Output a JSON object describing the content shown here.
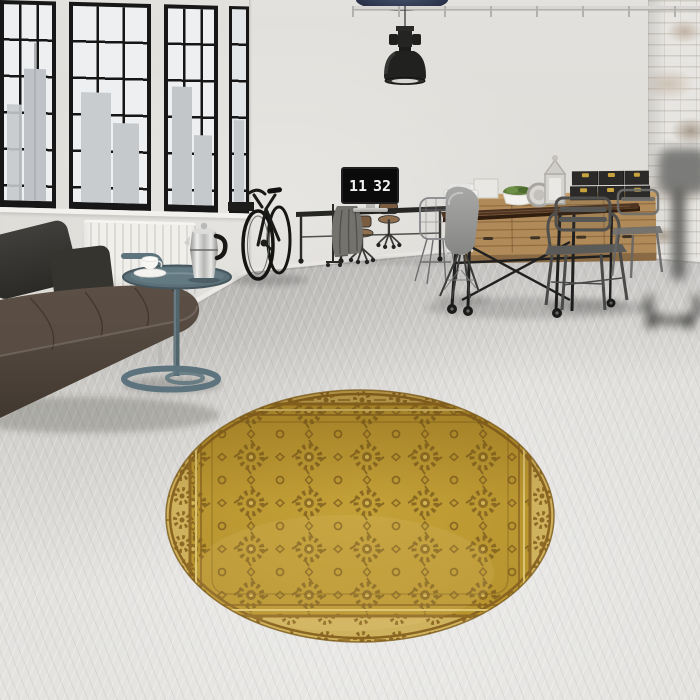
{
  "scene_label": "loft interior with round gold oriental rug",
  "clock_display": {
    "hours": "11",
    "minutes": "32"
  },
  "palette": {
    "wall": "#dedcd7",
    "window_frame": "#171717",
    "window_pane": "#edeff0",
    "building": "#c5c9cc",
    "radiator": "#f0efeb",
    "sofa_top": "#5e5248",
    "sofa_bottom": "#41382f",
    "pillow": "#36342f",
    "table_teal": "#5d747e",
    "chrome": "#c9c9c7",
    "rug_field": "#c4a138",
    "rug_field_dark": "#b6922d",
    "rug_border": "#cfb25d",
    "rug_motif": "#7d5e1e",
    "rug_guard": "#8a6522",
    "wood_light": "#b08a58",
    "wood_table": "#4c3322",
    "iron_black": "#202020",
    "chair_gray": "#9a9a98",
    "brass": "#c8a23c",
    "box_black": "#2b2a28",
    "lamp_black": "#212120",
    "duct_navy": "#2a3349",
    "garment_gray": "#73726d",
    "brick_patch": "#a89c8e"
  }
}
